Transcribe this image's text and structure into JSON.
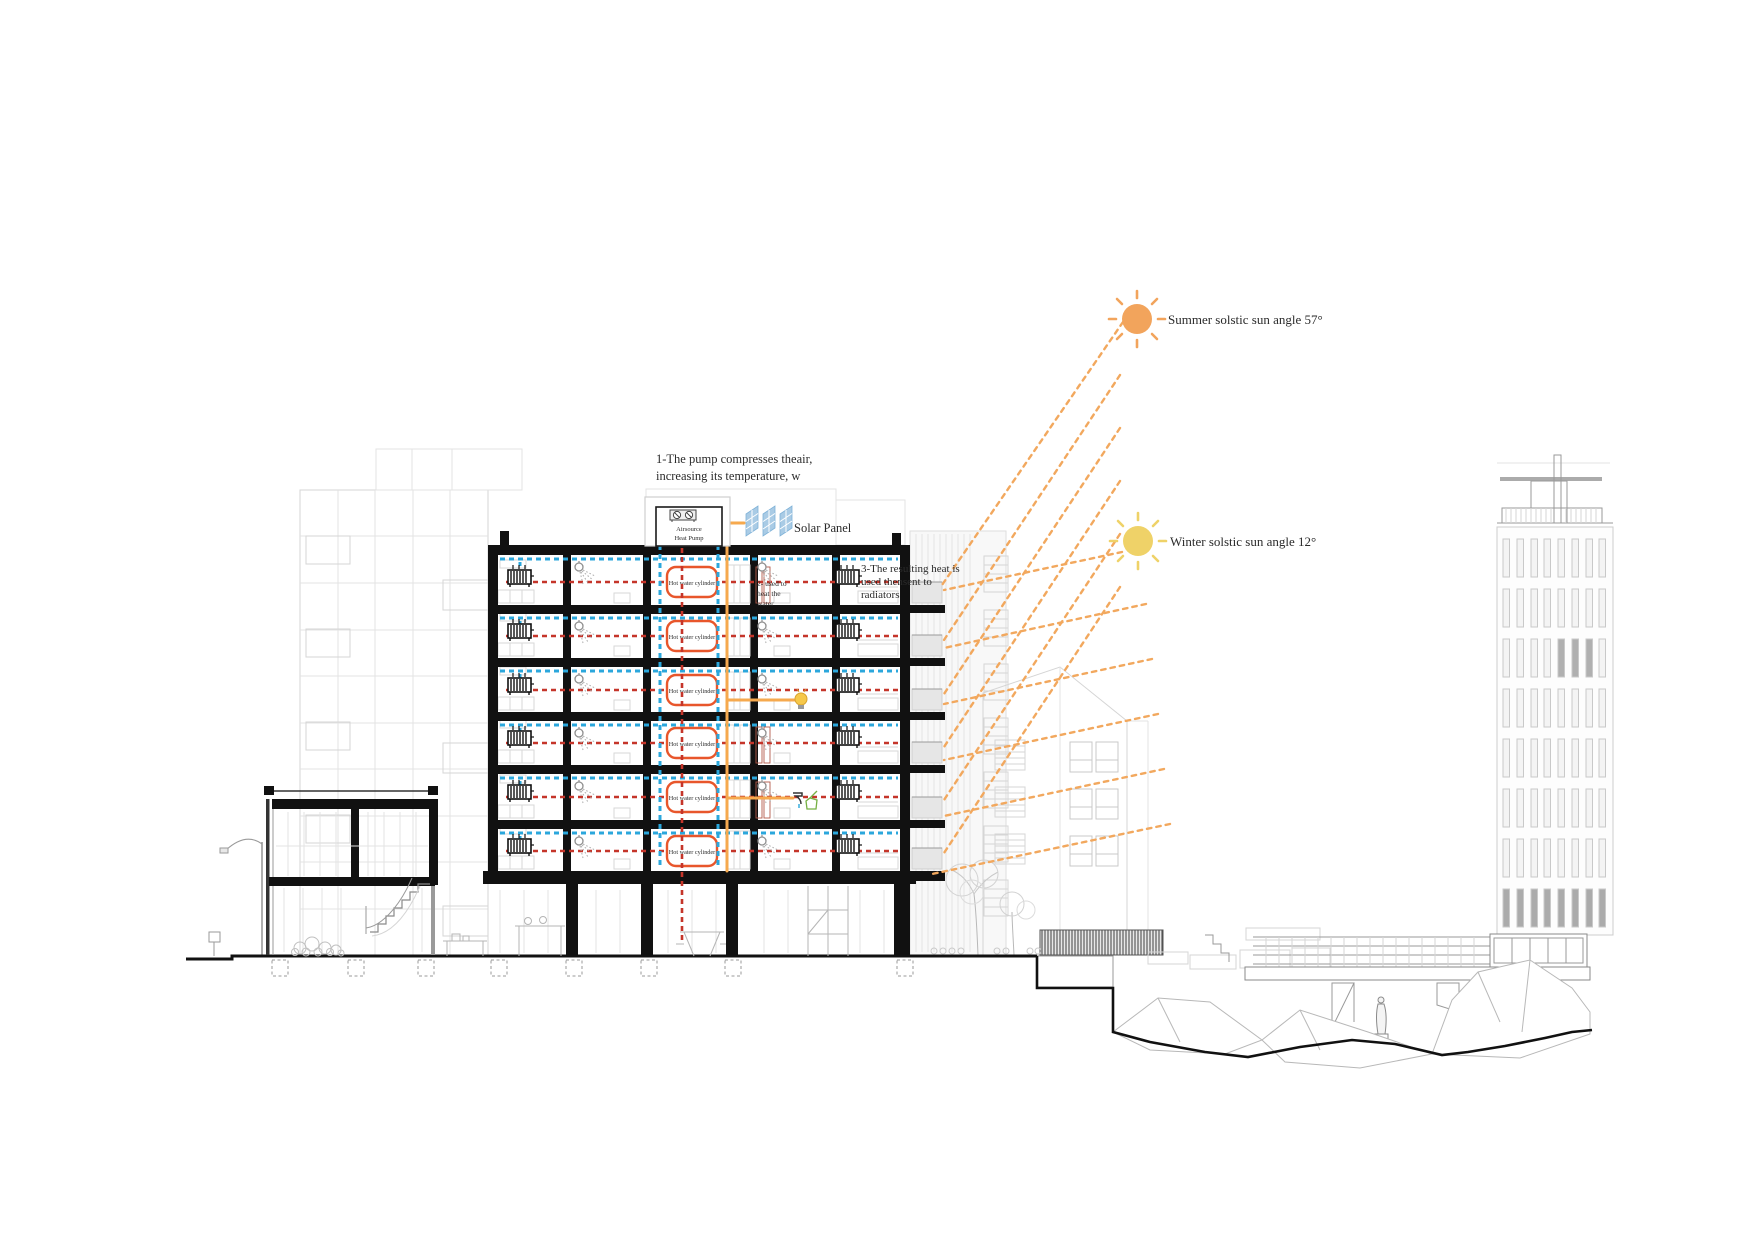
{
  "annotations": {
    "pump_note": {
      "line1": "1-The pump compresses theair,",
      "line2": "increasing its temperature, w"
    },
    "heat_pump": {
      "line1": "Airsource",
      "line2": "Heat Pump"
    },
    "solar_panel_label": "Solar Panel",
    "water_note": {
      "line1": "2- used to",
      "line2": "heat the",
      "line3": "water"
    },
    "radiator_note": {
      "line1": "3-The resulting heat is",
      "line2": "used thensent to",
      "line3": "radiators"
    },
    "summer_sun_label": "Summer solstic sun angle 57°",
    "winter_sun_label": "Winter solstic sun angle 12°"
  },
  "building": {
    "floors": [
      {
        "cylinder_label": "Hot water cylinder"
      },
      {
        "cylinder_label": "Hot water cylinder"
      },
      {
        "cylinder_label": "Hot water cylinder"
      },
      {
        "cylinder_label": "Hot water cylinder"
      },
      {
        "cylinder_label": "Hot water cylinder"
      },
      {
        "cylinder_label": "Hot water cylinder"
      }
    ]
  },
  "legend_colors": {
    "hot_loop": "#c5352a",
    "cold_loop": "#2ba7dc",
    "sun_ray": "#f2a85e",
    "supply_line": "#f6a94e",
    "cylinder_outline": "#e8562b",
    "summer_sun": "#f2a45c",
    "winter_sun": "#efd268",
    "solar_panel": "#a9cbe5"
  }
}
